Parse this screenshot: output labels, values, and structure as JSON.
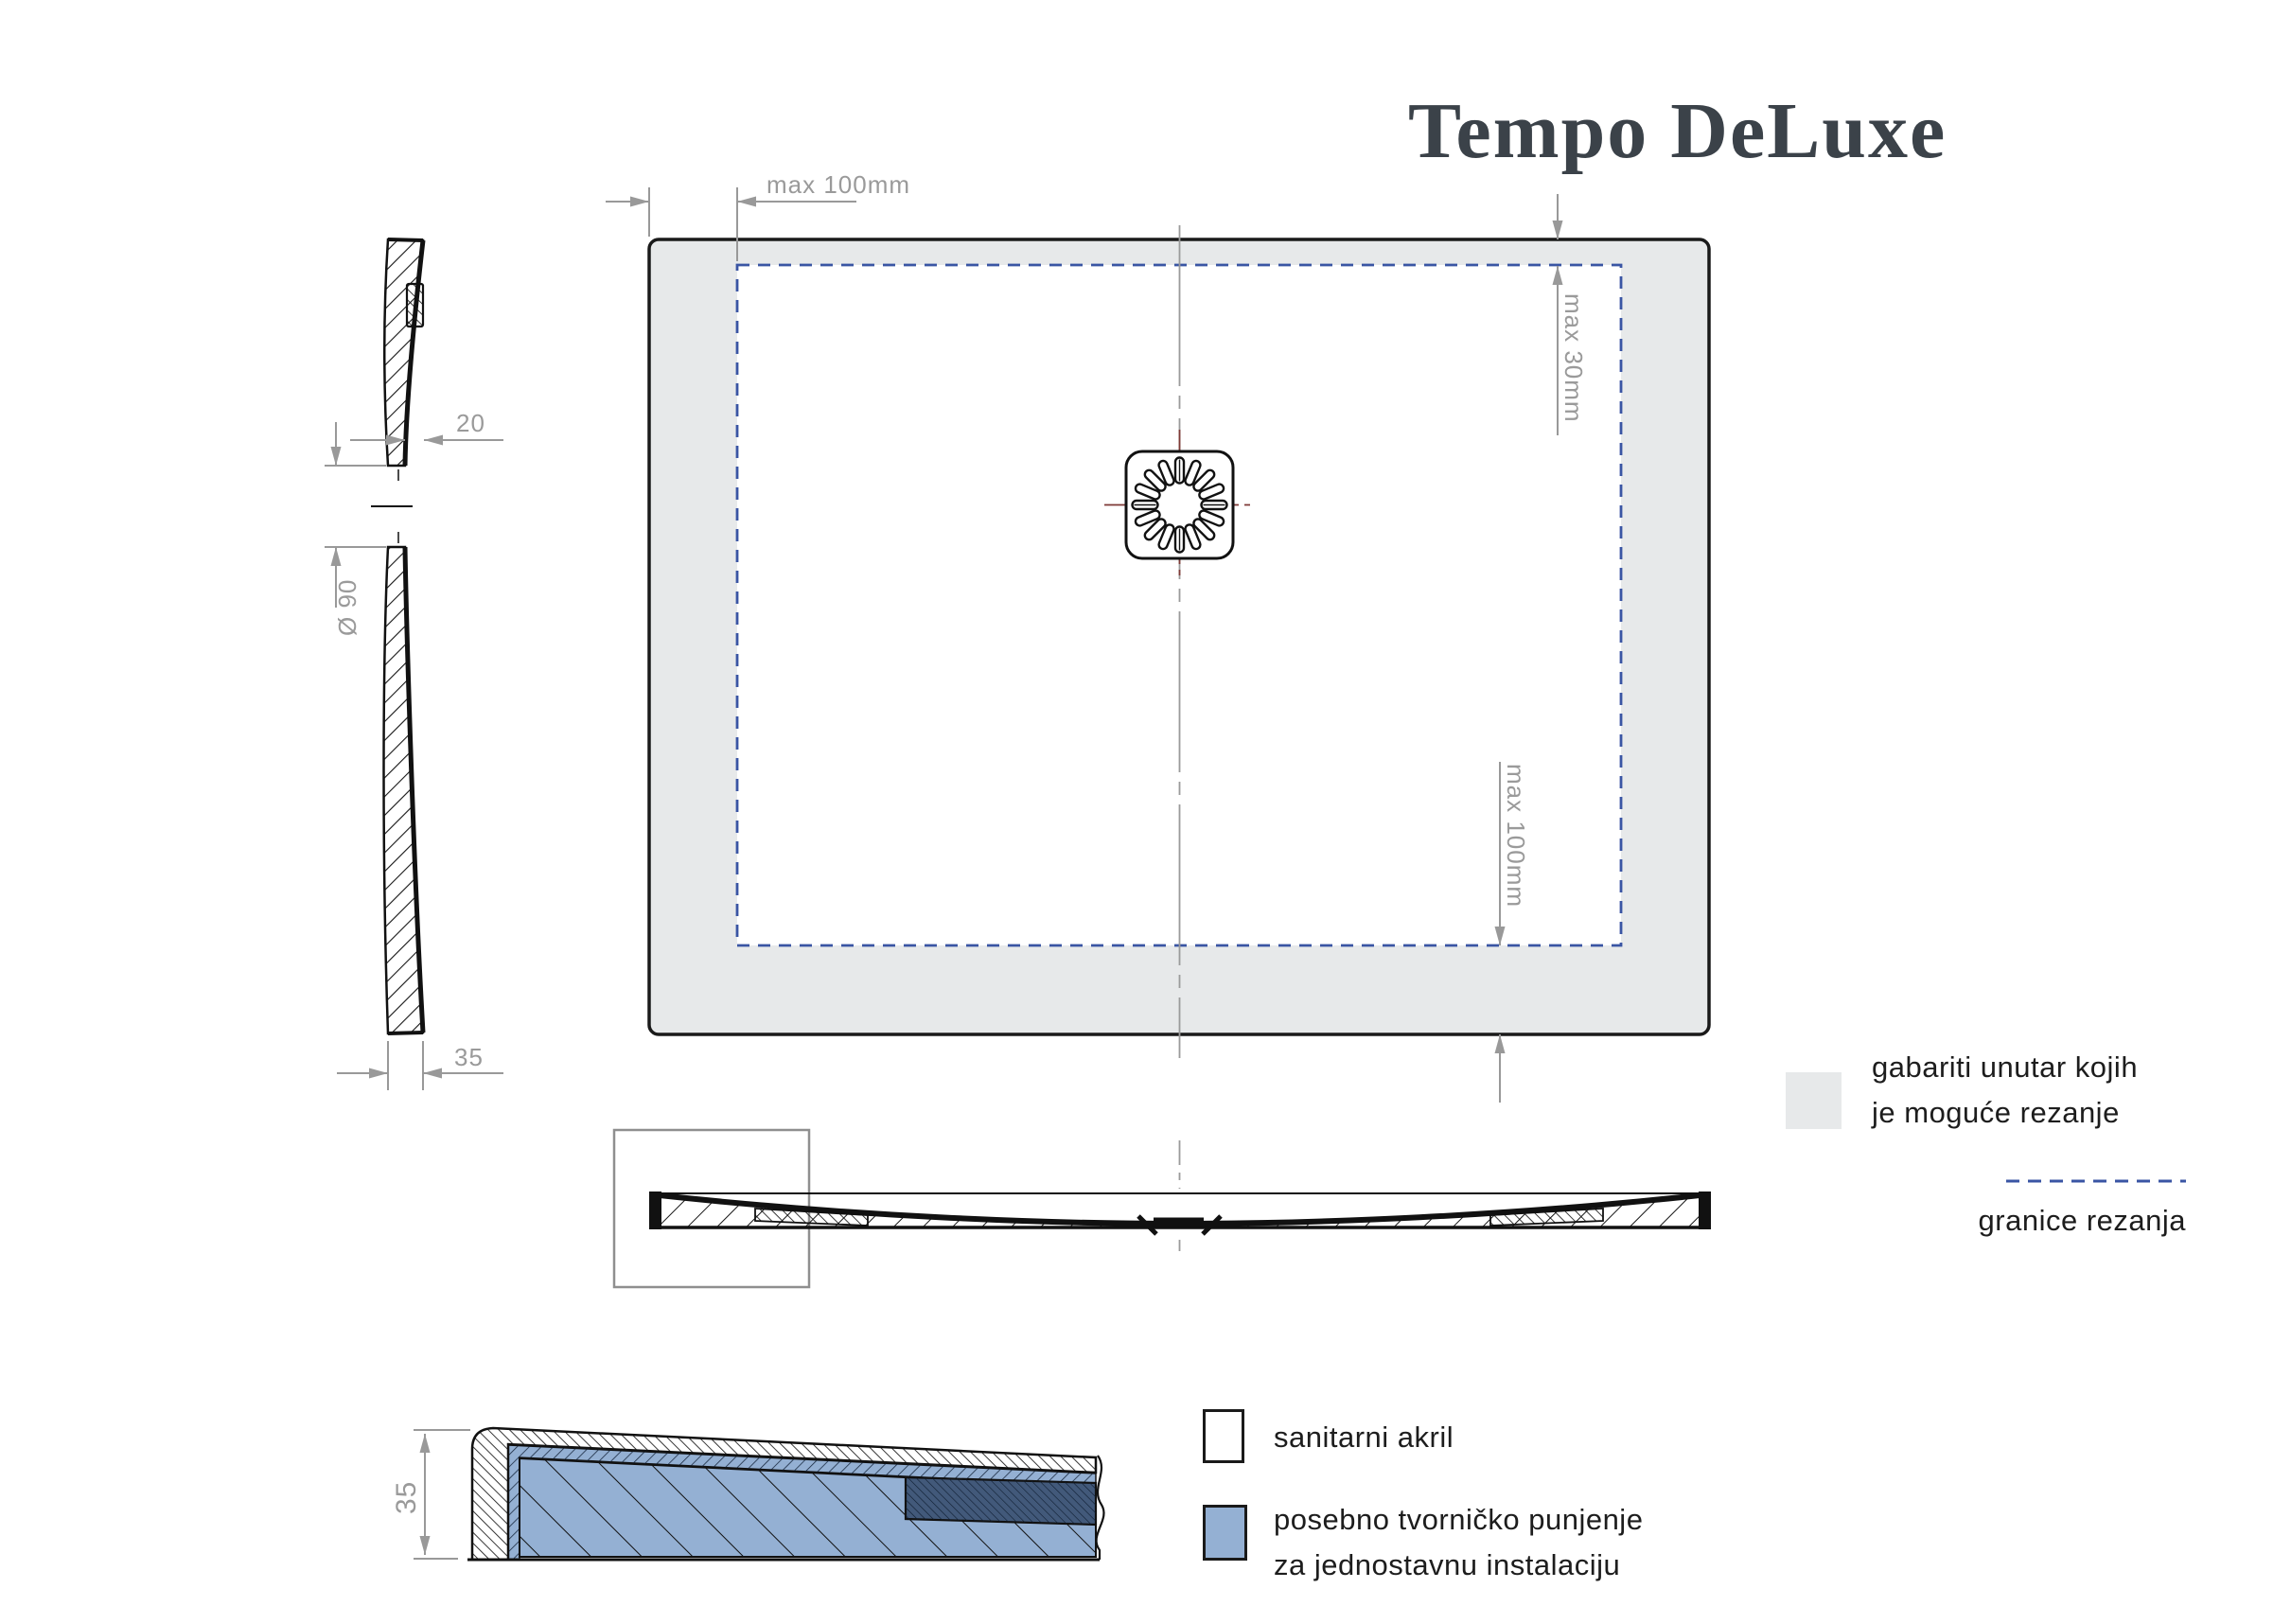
{
  "title": "Tempo DeLuxe",
  "plan_view": {
    "dim_left_margin": "max 100mm",
    "dim_top_margin": "max 30mm",
    "dim_bottom_margin": "max 100mm"
  },
  "side_view": {
    "dim_center_thickness": "20",
    "dim_drain_diameter": "Ø 90",
    "dim_edge_height": "35"
  },
  "detail_view": {
    "dim_edge_height": "35"
  },
  "cut_legend": {
    "area_line1": "gabariti unutar kojih",
    "area_line2": "je moguće rezanje",
    "boundary_label": "granice rezanja"
  },
  "material_legend": {
    "acrylic_label": "sanitarni akril",
    "filling_line1": "posebno tvorničko punjenje",
    "filling_line2": "za jednostavnu instalaciju"
  },
  "colors": {
    "cut_area_fill": "#e7e9ea",
    "cut_boundary_line": "#3a55a4",
    "factory_filling_blue": "#94b0d3",
    "dense_filling_navy": "#42597a",
    "dimension_gray": "#9a9a9a",
    "drain_centerline_red": "#7e3a36",
    "drawing_line": "#1a1a1a",
    "title_color": "#3b4249"
  }
}
